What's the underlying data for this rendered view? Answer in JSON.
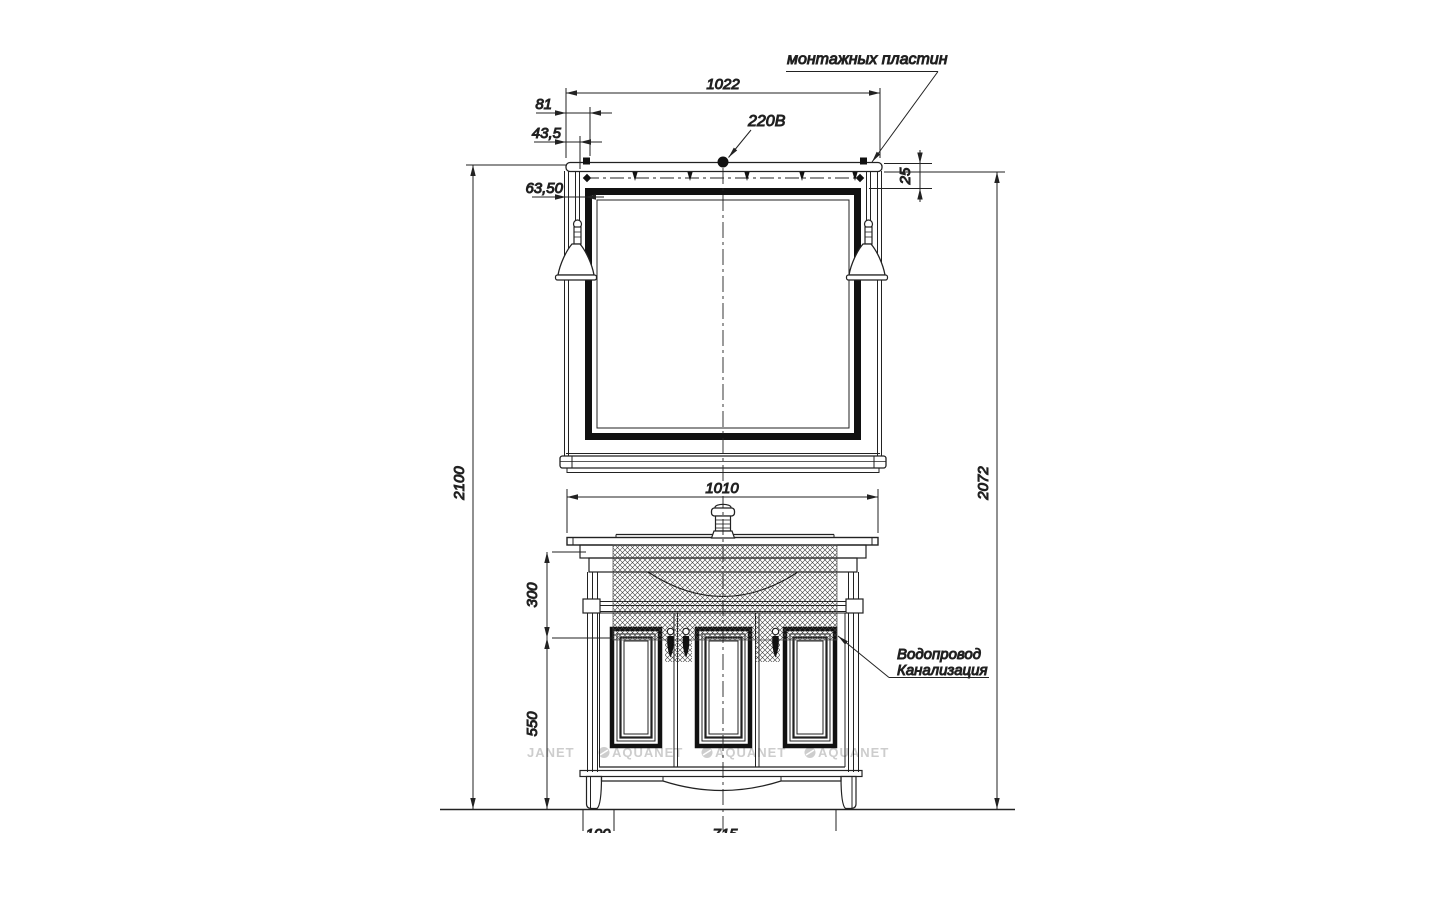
{
  "meta": {
    "drawing_type": "furniture installation drawing",
    "subject": "bathroom vanity with mirror and lamps, front view"
  },
  "annotations": {
    "mounting_plates": "монтажных пластин",
    "power_supply": "220В",
    "plumbing_line1": "Водопровод",
    "plumbing_line2": "Канализация"
  },
  "dimensions": {
    "mirror_width": "1022",
    "plate_offset": "81",
    "lamp_offset": "43,5",
    "frame_width": "63,50",
    "plate_drop": "25",
    "total_height": "2100",
    "upper_height": "2072",
    "vanity_width": "1010",
    "top_section_height": "300",
    "cabinet_height": "550",
    "leg_inset_partial": "100",
    "leg_span_partial": "715"
  },
  "watermarks": {
    "partial": "JANET",
    "brand": "AQUANET"
  },
  "colors": {
    "line": "#222222",
    "heavy_line": "#111111",
    "watermark": "#cdcdcd",
    "background": "#ffffff"
  }
}
